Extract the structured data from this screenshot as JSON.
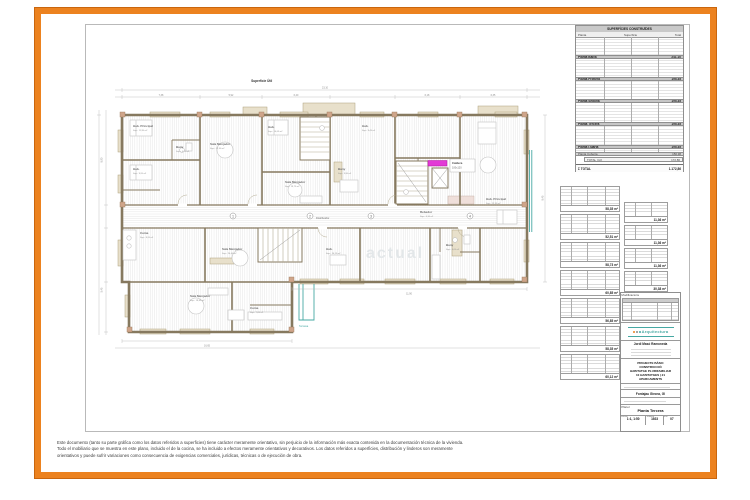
{
  "colors": {
    "accent_orange": "#ec821f",
    "wall_taupe": "#86795f",
    "beige": "#e8e0cb",
    "teal": "#46a8a3",
    "magenta": "#e23ad6"
  },
  "plan": {
    "watermark": "actual",
    "highlight": {
      "l1": "Caldera",
      "l2": "100x120"
    },
    "marks": [
      "1",
      "2",
      "3",
      "4"
    ],
    "rooms": [
      {
        "n": "Hab. Principal",
        "s": "Sup.: 11,95 m²"
      },
      {
        "n": "Hab.",
        "s": "Sup.: 9,20 m²"
      },
      {
        "n": "Bany",
        "s": "Sup.: 4,15 m²"
      },
      {
        "n": "Sala Menjador",
        "s": "Sup.: 21,30 m²"
      },
      {
        "n": "Hab.",
        "s": "Sup.: 10,05 m²"
      },
      {
        "n": "Sala Menjador",
        "s": "Sup.: 19,75 m²"
      },
      {
        "n": "Bany",
        "s": "Sup.: 3,90 m²"
      },
      {
        "n": "Hab.",
        "s": "Sup.: 9,45 m²"
      },
      {
        "n": "Rebedor",
        "s": "Sup.: 6,10 m²"
      },
      {
        "n": "Hab. Principal",
        "s": "Sup.: 12,35 m²"
      },
      {
        "n": "Cuina",
        "s": "Sup.: 8,20 m²"
      },
      {
        "n": "Sala Menjador",
        "s": "Sup.: 20,40 m²"
      },
      {
        "n": "Sala Menjador",
        "s": "Sup.: 19,85 m²"
      },
      {
        "n": "Cuina",
        "s": "Sup.: 7,65 m²"
      },
      {
        "n": "Distribuïdor",
        "s": ""
      },
      {
        "n": "Bany",
        "s": "Sup.: 4,05 m²"
      },
      {
        "n": "Hab.",
        "s": "Sup.: 10,15 m²"
      },
      {
        "n": "Terrassa",
        "s": "Sup.: 5,30 m²"
      }
    ],
    "dims": {
      "top": [
        "7,38",
        "5,92",
        "6,40",
        "6,18",
        "6,35"
      ],
      "top_total": "23,10",
      "bottom_left": "16,65",
      "bottom_right": "11,90",
      "left_upper": "8,90",
      "left_lower": "5,45",
      "right": "8,45"
    }
  },
  "surface_tables": {
    "built": {
      "title": "SUPERFÍCIES CONSTRUÏDES",
      "col_planta": "Planta",
      "col_superficie": "Superfície",
      "col_total": "Total",
      "sections": [
        {
          "label": "Planta Baixa",
          "value": "241,10"
        },
        {
          "label": "Planta Primera",
          "value": "195,35"
        },
        {
          "label": "Planta Segona",
          "value": "195,35"
        },
        {
          "label": "Planta Tercera",
          "value": "195,35"
        },
        {
          "label": "Planta Quarta",
          "value": "195,35"
        },
        {
          "label": "Planta Coberta",
          "value": "150,38"
        }
      ],
      "subtotal_label": "TOTAL (m²)",
      "subtotal_value": "172,86",
      "total_label": "Σ TOTAL",
      "total_value": "1.172,86"
    },
    "useful": {
      "title": "Superficie Útil",
      "left_totals": [
        "58,35 m²",
        "52,51 m²",
        "58,73 m²",
        "60,85 m²",
        "56,85 m²",
        "58,35 m²",
        "60,12 m²"
      ],
      "right_totals": [
        "11,36 m²",
        "11,36 m²",
        "11,36 m²",
        "30,38 m²"
      ]
    }
  },
  "titleblock": {
    "revisions_label": "Modificacions",
    "logo_name": "Arquitectura",
    "architect": "Jordi Masó Ramoneda",
    "project_lines": [
      "PROJECTE BÀSIC",
      "CONSTRUCCIÓ",
      "HABITATGE PLURIFAMILIAR",
      "10 HABITATGES | 21",
      "APARCAMENTS"
    ],
    "location": "Fontajau Girona, GI",
    "plan_label": "Plànol",
    "plan_name": "Planta Tercera",
    "cells": [
      {
        "h": "Escala",
        "v": "1:1, 1:50"
      },
      {
        "h": "Número",
        "v": "1923"
      },
      {
        "h": "Full",
        "v": "07"
      }
    ]
  },
  "footer": {
    "lines": [
      "Este documento (tanto su parte gráfica como los datos referidos a superficies) tiene carácter meramente orientativo, sin perjuicio de la información más exacta contenida en la documentación técnica de la vivienda.",
      "Todo el mobiliario que se muestra en este plano, incluido el de la cocina, se ha incluido a efectos meramente orientativos y decorativos. Los datos referidos a superficies, distribución y linderos son meramente",
      "orientativos y puede sufrir variaciones como consecuencia de exigencias comerciales, jurídicas, técnicas o de ejecución de obra."
    ]
  }
}
